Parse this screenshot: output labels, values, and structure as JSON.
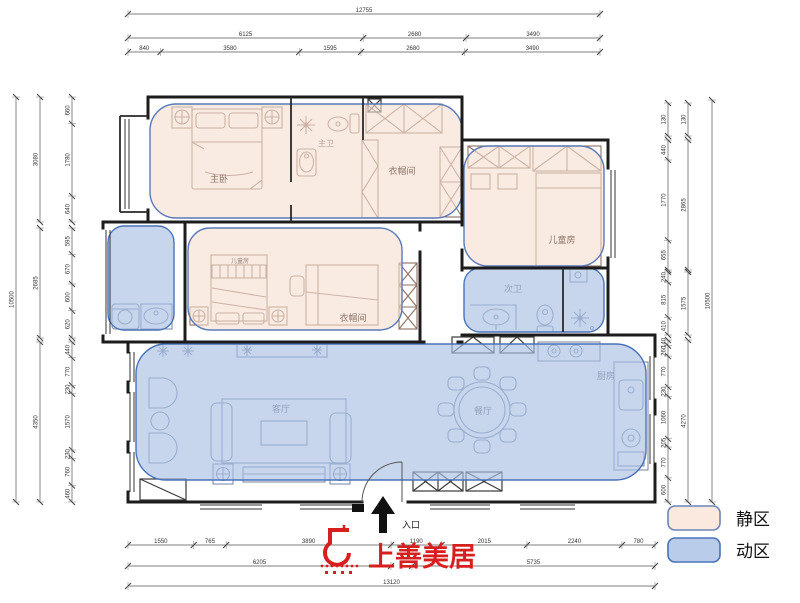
{
  "rooms": {
    "master_bedroom": "主卧",
    "master_bath": "主卫",
    "cloakroom_top": "衣帽间",
    "cloakroom_mid": "衣帽间",
    "kids_room": "儿童房",
    "kids_bed_label": "儿童房",
    "second_bath": "次卫",
    "living_room": "客厅",
    "dining_room": "餐厅",
    "kitchen": "厨房",
    "entrance": "入口"
  },
  "legend": {
    "quiet": {
      "label": "静区",
      "fill": "#fbe9e0",
      "border": "#6c86b8"
    },
    "active": {
      "label": "动区",
      "fill": "#b9cce9",
      "border": "#4a72b8"
    }
  },
  "logo": {
    "text": "上善美居",
    "color": "#d71f1f"
  },
  "zone_colors": {
    "quiet_fill": "#f6ddd0",
    "active_fill": "#a9c0e4",
    "zone_border": "#5b7ab8"
  },
  "dims": {
    "top": {
      "row1": [
        "12755"
      ],
      "row2": [
        "6125",
        "2680",
        "3490"
      ],
      "row3": [
        "840",
        "3580",
        "1595",
        "2680",
        "3490"
      ]
    },
    "bottom": {
      "row1": [
        "1550",
        "765",
        "3890",
        "1190",
        "2015",
        "2240",
        "780"
      ],
      "row2a": [
        "6205"
      ],
      "row2b": [
        "5735"
      ],
      "row3": [
        "13120"
      ]
    },
    "left": {
      "outer": [
        "10500"
      ],
      "mid1": [
        "3080"
      ],
      "mid2": [
        "2685"
      ],
      "mid3": [
        "4350"
      ],
      "inner1": [
        "660",
        "1780",
        "640"
      ],
      "inner2": [
        "595",
        "670",
        "600",
        "620"
      ],
      "inner3": [
        "440",
        "770",
        "230",
        "1570",
        "230",
        "760",
        "460"
      ]
    },
    "right": {
      "outer": [
        "10500"
      ],
      "top1": [
        "130"
      ],
      "top2": [
        "130"
      ],
      "mid1": [
        "2865"
      ],
      "mid2": [
        "1575"
      ],
      "mid3": [
        "4270"
      ],
      "inner1": [
        "440",
        "1770",
        "655"
      ],
      "inner2": [
        "240",
        "815",
        "410"
      ],
      "inner3": [
        "140",
        "260",
        "770",
        "230",
        "1060",
        "205",
        "770",
        "600"
      ]
    }
  }
}
